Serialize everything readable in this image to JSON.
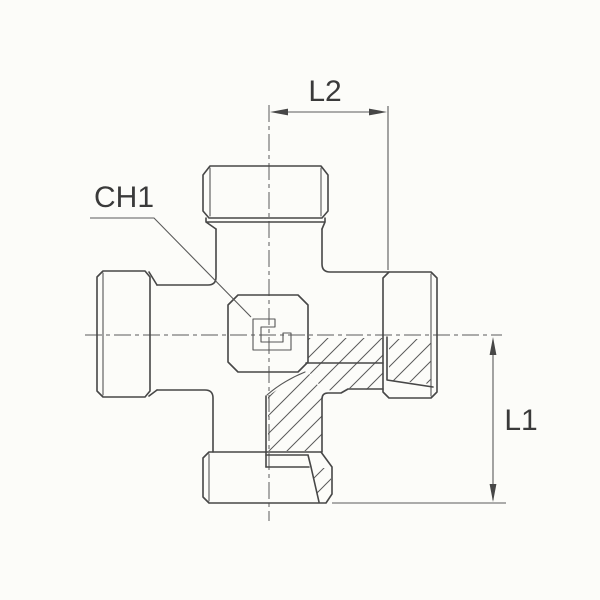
{
  "drawing": {
    "labels": {
      "l2": "L2",
      "l1": "L1",
      "ch1": "CH1"
    }
  },
  "colors": {
    "background": "#fcfcf9",
    "outline": "#474747",
    "thin_line": "#5a5a5a",
    "hatch": "#5a5a5a",
    "text": "#3a3a3a"
  }
}
